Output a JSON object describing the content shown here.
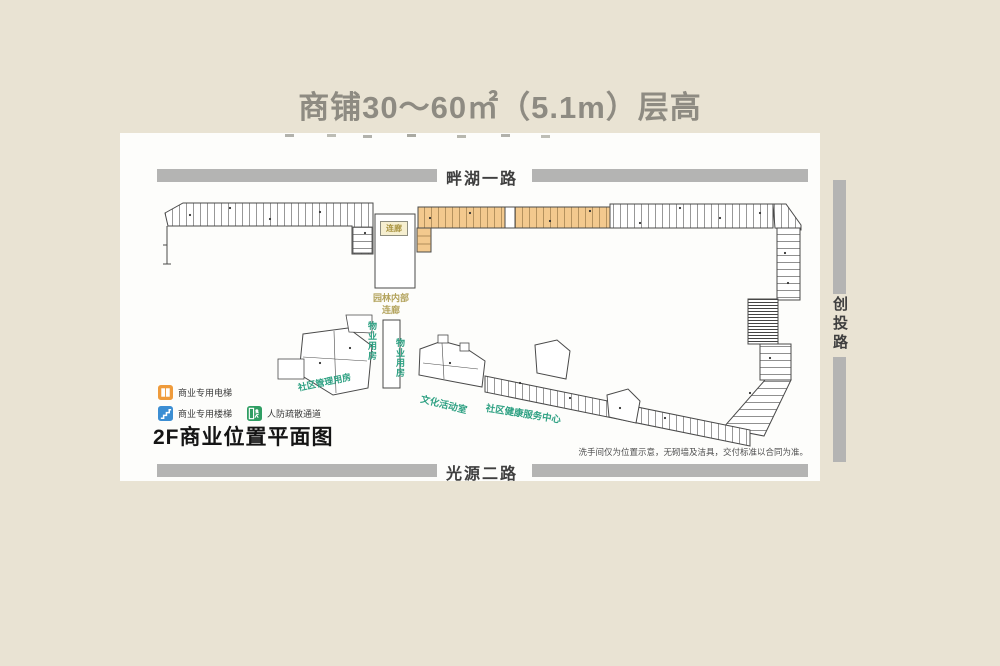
{
  "title": "商铺30～60㎡（5.1m）层高",
  "roads": {
    "top": "畔湖一路",
    "right": "创投路",
    "bottom": "光源二路"
  },
  "plan": {
    "heading": "2F商业位置平面图",
    "note": "洗手间仅为位置示意，无砌墙及洁具，交付标准以合同为准。",
    "labels": {
      "corridor_box": "连廊",
      "garden_corridor": [
        "园林内部",
        "连廊"
      ],
      "property_room_left": "物业用房",
      "property_room_right": "物业用房",
      "community_management": "社区管理用房",
      "culture_activity_room": "文化活动室",
      "community_health_center": "社区健康服务中心"
    },
    "legend": [
      {
        "icon": "elevator-icon",
        "label": "商业专用电梯",
        "color": "#ef9b3b"
      },
      {
        "icon": "stairs-icon",
        "label": "商业专用楼梯",
        "color": "#3c8ed3"
      },
      {
        "icon": "evacuation-icon",
        "label": "人防疏散通道",
        "color": "#2f9e63"
      }
    ]
  },
  "colors": {
    "background": "#e9e3d3",
    "panel": "#fdfdfb",
    "road_bar": "#b4b4b3",
    "outline": "#4a4a4a",
    "shop_highlight": "#f3c98e",
    "green_label": "#2fa183",
    "tan_label": "#b3a35c",
    "title_gray": "#8e8b82"
  }
}
